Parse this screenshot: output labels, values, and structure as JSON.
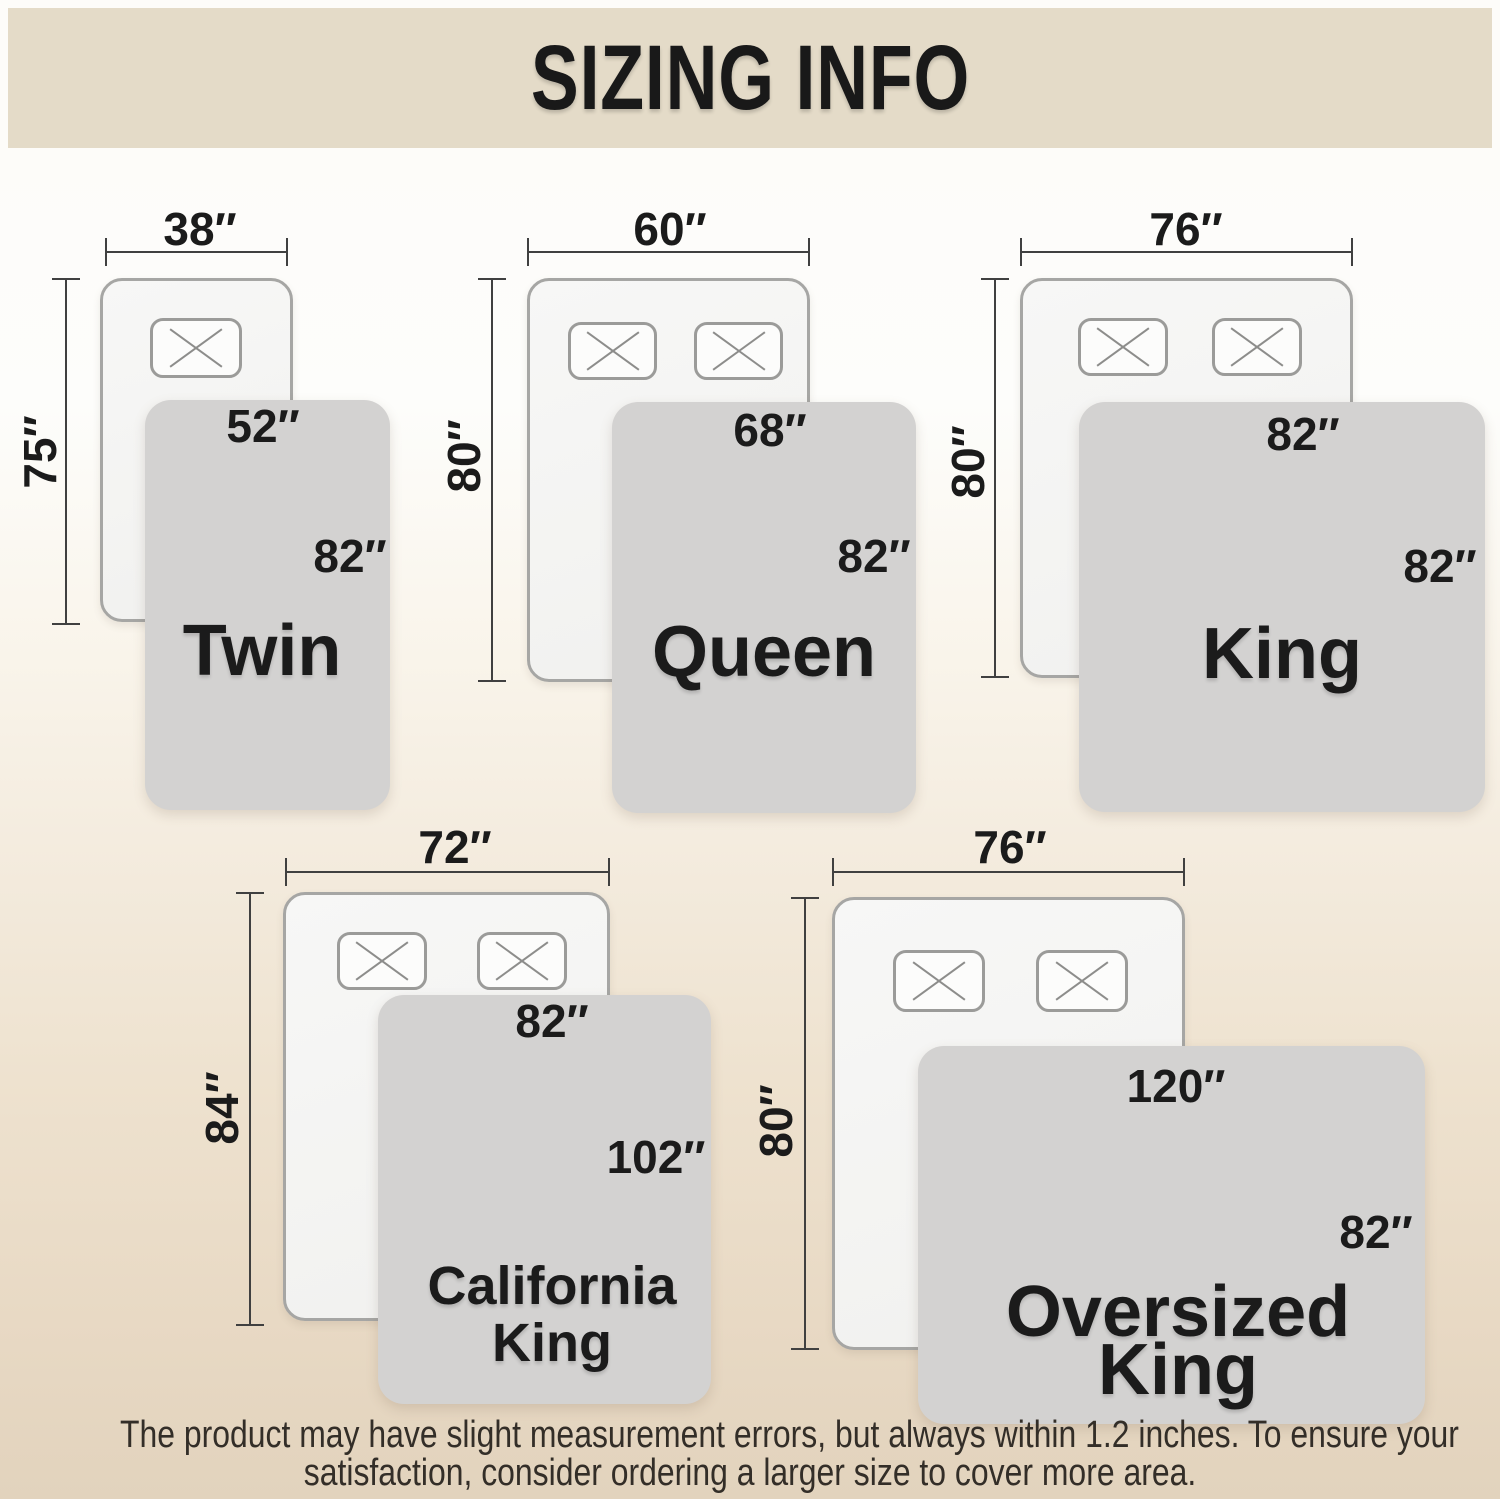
{
  "title": "SIZING INFO",
  "footer": {
    "line1": "The product may have slight measurement errors, but always within 1.2 inches. To ensure your",
    "line2": "satisfaction, consider ordering a larger size to cover more area."
  },
  "colors": {
    "banner_bg": "#e4dbc8",
    "page_top": "#fdfcf9",
    "page_bottom": "#e2d3bd",
    "bed_fill": "#f1f1ef",
    "bed_border": "#a6a6a4",
    "pillow_fill": "#fcfcfb",
    "pillow_border": "#9b9b99",
    "pillow_cross": "#8d8d8b",
    "blanket_fill": "#d3d2d1",
    "dim_line": "#404040",
    "text": "#1b1b1b"
  },
  "sizes": [
    {
      "name_line1": "Twin",
      "bed_width": "38″",
      "bed_length": "75″",
      "blanket_width": "52″",
      "blanket_length": "82″"
    },
    {
      "name_line1": "Queen",
      "bed_width": "60″",
      "bed_length": "80″",
      "blanket_width": "68″",
      "blanket_length": "82″"
    },
    {
      "name_line1": "King",
      "bed_width": "76″",
      "bed_length": "80″",
      "blanket_width": "82″",
      "blanket_length": "82″"
    },
    {
      "name_line1": "California",
      "name_line2": "King",
      "bed_width": "72″",
      "bed_length": "84″",
      "blanket_width": "82″",
      "blanket_length": "102″"
    },
    {
      "name_line1": "Oversized",
      "name_line2": "King",
      "bed_width": "76″",
      "bed_length": "80″",
      "blanket_width": "120″",
      "blanket_length": "82″"
    }
  ]
}
